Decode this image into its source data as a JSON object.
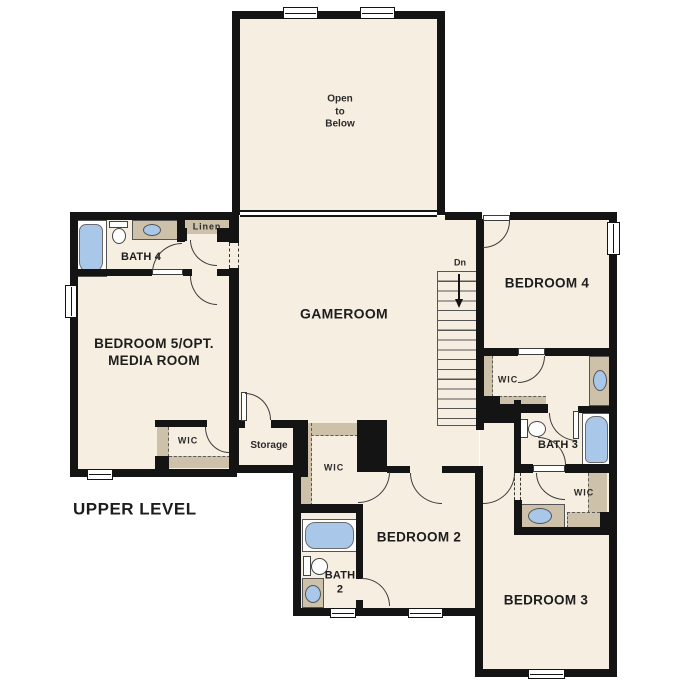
{
  "plan": {
    "level_title": "UPPER LEVEL",
    "rooms": {
      "open_to_below": "Open\nto\nBelow",
      "gameroom": "GAMEROOM",
      "bedroom4": "BEDROOM 4",
      "bedroom5": "BEDROOM 5/OPT.\nMEDIA ROOM",
      "bedroom2": "BEDROOM 2",
      "bedroom3": "BEDROOM 3",
      "bath4": "BATH 4",
      "bath3": "BATH 3",
      "bath2": "BATH\n2"
    },
    "closets": {
      "wic": "WIC",
      "linen": "Linen",
      "storage": "Storage"
    },
    "stairs": {
      "direction_label": "Dn"
    },
    "colors": {
      "background": "#ffffff",
      "floor": "#f6eee1",
      "wall": "#141414",
      "cabinet_tan": "#cdc1a9",
      "fixture_blue": "#a9c7e8"
    }
  }
}
